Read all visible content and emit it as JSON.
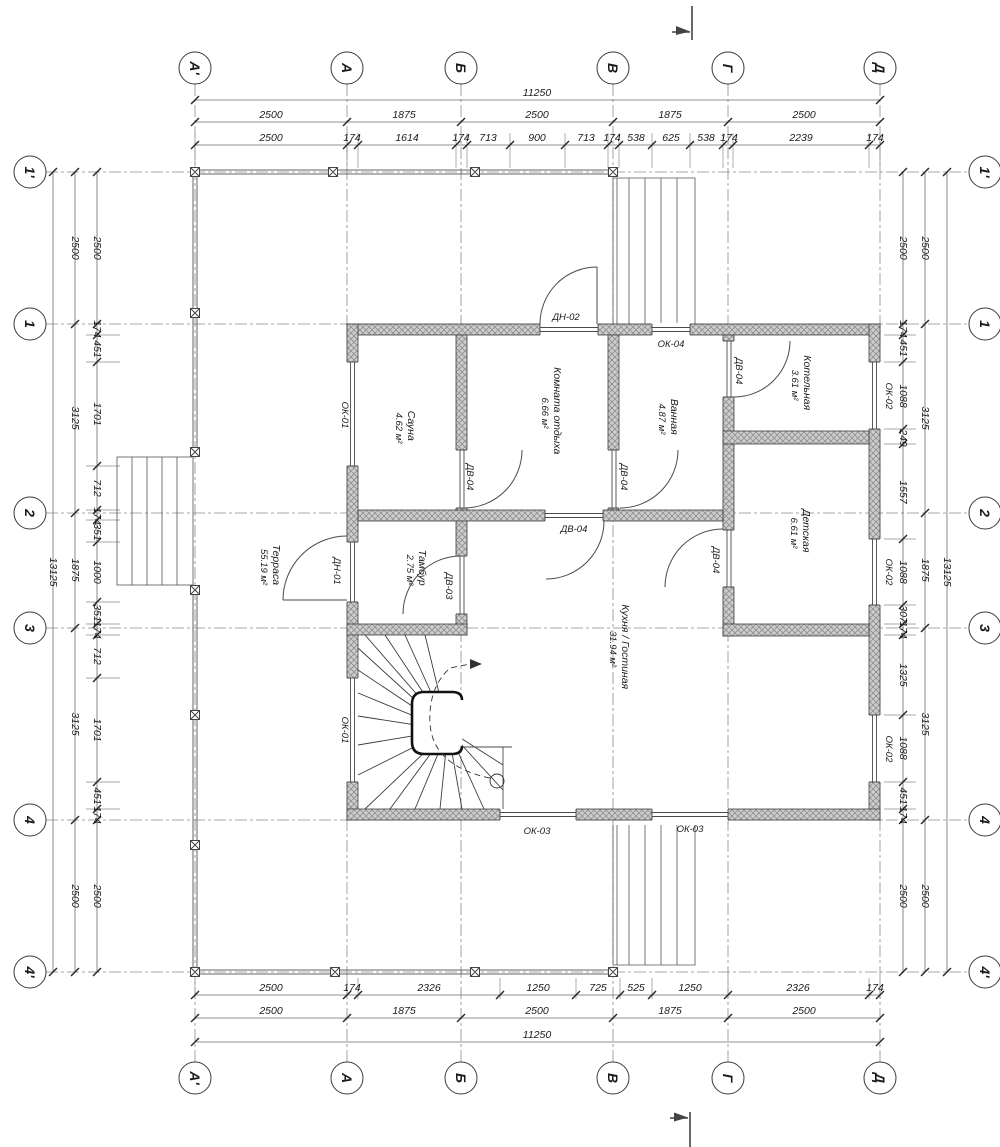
{
  "drawing_type": "floor-plan",
  "axes": {
    "horizontal": [
      "А'",
      "А",
      "Б",
      "В",
      "Г",
      "Д"
    ],
    "vertical": [
      "1'",
      "1",
      "2",
      "3",
      "4",
      "4'"
    ]
  },
  "dimensions": {
    "top": {
      "total": "11250",
      "spans": [
        "2500",
        "1875",
        "2500",
        "1875",
        "2500"
      ],
      "detail": [
        "2500",
        "174",
        "1614",
        "174",
        "713",
        "900",
        "713",
        "174",
        "538",
        "625",
        "538",
        "174",
        "2239",
        "174"
      ]
    },
    "bottom": {
      "total": "11250",
      "spans": [
        "2500",
        "1875",
        "2500",
        "1875",
        "2500"
      ],
      "detail": [
        "2500",
        "174",
        "2326",
        "1250",
        "725",
        "525",
        "1250",
        "2326",
        "174"
      ]
    },
    "left": {
      "total": "13125",
      "spans": [
        "2500",
        "3125",
        "1875",
        "3125",
        "2500"
      ],
      "detail": [
        "2500",
        "174",
        "451",
        "1701",
        "712",
        "174",
        "351",
        "1000",
        "351",
        "174",
        "712",
        "1701",
        "451",
        "174",
        "2500"
      ]
    },
    "right": {
      "total": "13125",
      "spans": [
        "2500",
        "3125",
        "1875",
        "3125",
        "2500"
      ],
      "detail": [
        "2500",
        "174",
        "451",
        "1088",
        "249",
        "1557",
        "1088",
        "307",
        "174",
        "1325",
        "1088",
        "451",
        "174",
        "2500"
      ]
    }
  },
  "rooms": [
    {
      "name": "Сауна",
      "area": "4.62 м²"
    },
    {
      "name": "Комната отдыха",
      "area": "6.66 м²"
    },
    {
      "name": "Ванная",
      "area": "4.87 м²"
    },
    {
      "name": "Котельная",
      "area": "3.61 м²"
    },
    {
      "name": "Детская",
      "area": "6.61 м²"
    },
    {
      "name": "Кухня / Гостиная",
      "area": "31.94 м²"
    },
    {
      "name": "Тамбур",
      "area": "2.75 м²"
    },
    {
      "name": "Терраса",
      "area": "55.19 м²"
    }
  ],
  "openings": {
    "dn01": "ДН-01",
    "dn02": "ДН-02",
    "dv03": "ДВ-03",
    "dv04": "ДВ-04",
    "ok01": "ОК-01",
    "ok02": "ОК-02",
    "ok03": "ОК-03",
    "ok04": "ОК-04"
  },
  "colors": {
    "line": "#3d3d3d",
    "wall_fill": "#cdcdcd",
    "background": "#ffffff"
  }
}
